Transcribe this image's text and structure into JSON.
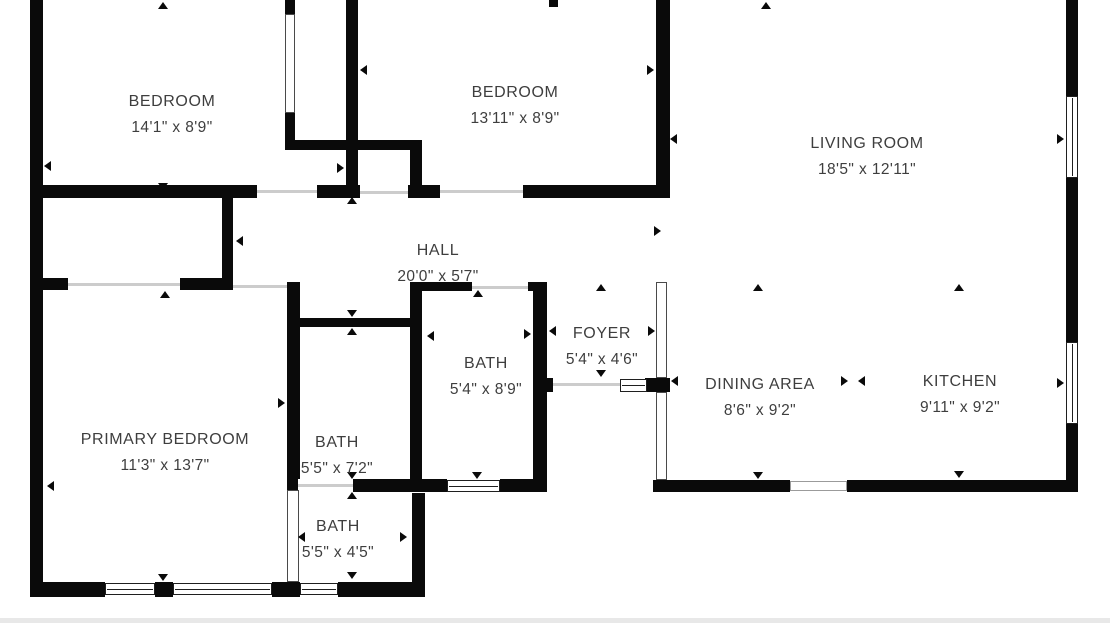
{
  "plan": {
    "width": 1110,
    "height": 623,
    "colors": {
      "wall": "#0a0a0a",
      "text": "#3e3e3e",
      "window_frame": "#1f1f1f",
      "opening_line": "#cccccc",
      "background": "#ffffff",
      "bottom_strip": "#e8e8e8"
    },
    "rooms": [
      {
        "name": "BEDROOM",
        "dims": "14'1\" x 8'9\"",
        "cx": 172,
        "cy": 93
      },
      {
        "name": "BEDROOM",
        "dims": "13'11\" x 8'9\"",
        "cx": 515,
        "cy": 84
      },
      {
        "name": "LIVING ROOM",
        "dims": "18'5\" x 12'11\"",
        "cx": 867,
        "cy": 135
      },
      {
        "name": "HALL",
        "dims": "20'0\" x 5'7\"",
        "cx": 438,
        "cy": 242
      },
      {
        "name": "FOYER",
        "dims": "5'4\" x 4'6\"",
        "cx": 602,
        "cy": 325
      },
      {
        "name": "BATH",
        "dims": "5'4\" x 8'9\"",
        "cx": 486,
        "cy": 355
      },
      {
        "name": "DINING AREA",
        "dims": "8'6\" x 9'2\"",
        "cx": 760,
        "cy": 376
      },
      {
        "name": "KITCHEN",
        "dims": "9'11\" x 9'2\"",
        "cx": 960,
        "cy": 373
      },
      {
        "name": "PRIMARY BEDROOM",
        "dims": "11'3\" x 13'7\"",
        "cx": 165,
        "cy": 431
      },
      {
        "name": "BATH",
        "dims": "5'5\" x 7'2\"",
        "cx": 337,
        "cy": 434
      },
      {
        "name": "BATH",
        "dims": "5'5\" x 4'5\"",
        "cx": 338,
        "cy": 518
      }
    ],
    "walls": [
      [
        30,
        0,
        13,
        597
      ],
      [
        285,
        0,
        10,
        14
      ],
      [
        285,
        113,
        10,
        37
      ],
      [
        346,
        0,
        12,
        198
      ],
      [
        549,
        0,
        9,
        7
      ],
      [
        656,
        0,
        14,
        198
      ],
      [
        1066,
        0,
        12,
        96
      ],
      [
        1066,
        178,
        12,
        164
      ],
      [
        1066,
        424,
        12,
        68
      ],
      [
        222,
        198,
        11,
        92
      ],
      [
        287,
        282,
        13,
        197
      ],
      [
        410,
        282,
        12,
        197
      ],
      [
        410,
        149,
        12,
        49
      ],
      [
        533,
        282,
        14,
        210
      ],
      [
        412,
        493,
        13,
        104
      ],
      [
        30,
        185,
        227,
        13
      ],
      [
        317,
        185,
        43,
        13
      ],
      [
        408,
        185,
        32,
        13
      ],
      [
        523,
        185,
        147,
        13
      ],
      [
        287,
        140,
        135,
        10
      ],
      [
        30,
        278,
        38,
        12
      ],
      [
        180,
        278,
        53,
        12
      ],
      [
        293,
        318,
        119,
        9
      ],
      [
        410,
        282,
        62,
        9
      ],
      [
        528,
        282,
        19,
        9
      ],
      [
        287,
        479,
        11,
        13
      ],
      [
        353,
        479,
        94,
        13
      ],
      [
        500,
        479,
        47,
        13
      ],
      [
        533,
        378,
        20,
        14
      ],
      [
        645,
        378,
        25,
        14
      ],
      [
        653,
        480,
        137,
        12
      ],
      [
        847,
        480,
        231,
        12
      ],
      [
        30,
        582,
        75,
        15
      ],
      [
        155,
        582,
        18,
        15
      ],
      [
        272,
        582,
        28,
        15
      ],
      [
        338,
        582,
        87,
        15
      ]
    ],
    "windows": [
      [
        1066,
        96,
        12,
        82,
        "v"
      ],
      [
        1066,
        342,
        12,
        82,
        "v"
      ],
      [
        105,
        583,
        50,
        12,
        "h"
      ],
      [
        173,
        583,
        99,
        12,
        "h"
      ],
      [
        300,
        583,
        38,
        12,
        "h"
      ],
      [
        447,
        480,
        53,
        12,
        "h"
      ],
      [
        620,
        379,
        27,
        13,
        "h"
      ]
    ],
    "glazed_partitions": [
      [
        656,
        282,
        11,
        96
      ],
      [
        656,
        392,
        11,
        88
      ],
      [
        287,
        490,
        12,
        92
      ],
      [
        285,
        14,
        10,
        99
      ]
    ],
    "door_openings": [
      [
        257,
        190,
        60,
        3
      ],
      [
        440,
        190,
        83,
        3
      ],
      [
        68,
        283,
        112,
        3
      ],
      [
        233,
        285,
        54,
        3
      ],
      [
        472,
        286,
        56,
        3
      ],
      [
        298,
        484,
        55,
        3
      ],
      [
        553,
        383,
        67,
        3
      ],
      [
        360,
        191,
        48,
        3
      ]
    ],
    "sliding_doors": [
      [
        790,
        481,
        57,
        10
      ]
    ],
    "dimension_arrows": [
      {
        "x": 163,
        "y": 2,
        "d": "up"
      },
      {
        "x": 766,
        "y": 2,
        "d": "up"
      },
      {
        "x": 44,
        "y": 166,
        "d": "left"
      },
      {
        "x": 344,
        "y": 168,
        "d": "right"
      },
      {
        "x": 163,
        "y": 190,
        "d": "down"
      },
      {
        "x": 352,
        "y": 197,
        "d": "up"
      },
      {
        "x": 360,
        "y": 70,
        "d": "left"
      },
      {
        "x": 654,
        "y": 70,
        "d": "right"
      },
      {
        "x": 670,
        "y": 139,
        "d": "left"
      },
      {
        "x": 1064,
        "y": 139,
        "d": "right"
      },
      {
        "x": 236,
        "y": 241,
        "d": "left"
      },
      {
        "x": 661,
        "y": 231,
        "d": "right"
      },
      {
        "x": 165,
        "y": 291,
        "d": "up"
      },
      {
        "x": 285,
        "y": 403,
        "d": "right"
      },
      {
        "x": 47,
        "y": 486,
        "d": "left"
      },
      {
        "x": 163,
        "y": 581,
        "d": "down"
      },
      {
        "x": 352,
        "y": 317,
        "d": "down"
      },
      {
        "x": 352,
        "y": 328,
        "d": "up"
      },
      {
        "x": 427,
        "y": 336,
        "d": "left"
      },
      {
        "x": 531,
        "y": 334,
        "d": "right"
      },
      {
        "x": 478,
        "y": 290,
        "d": "up"
      },
      {
        "x": 477,
        "y": 479,
        "d": "down"
      },
      {
        "x": 601,
        "y": 284,
        "d": "up"
      },
      {
        "x": 601,
        "y": 377,
        "d": "down"
      },
      {
        "x": 549,
        "y": 331,
        "d": "left"
      },
      {
        "x": 655,
        "y": 331,
        "d": "right"
      },
      {
        "x": 671,
        "y": 381,
        "d": "left"
      },
      {
        "x": 848,
        "y": 381,
        "d": "right"
      },
      {
        "x": 858,
        "y": 381,
        "d": "left"
      },
      {
        "x": 758,
        "y": 284,
        "d": "up"
      },
      {
        "x": 758,
        "y": 479,
        "d": "down"
      },
      {
        "x": 959,
        "y": 284,
        "d": "up"
      },
      {
        "x": 959,
        "y": 478,
        "d": "down"
      },
      {
        "x": 1064,
        "y": 383,
        "d": "right"
      },
      {
        "x": 352,
        "y": 479,
        "d": "down"
      },
      {
        "x": 352,
        "y": 492,
        "d": "up"
      },
      {
        "x": 298,
        "y": 537,
        "d": "left"
      },
      {
        "x": 407,
        "y": 537,
        "d": "right"
      },
      {
        "x": 352,
        "y": 579,
        "d": "down"
      }
    ]
  }
}
